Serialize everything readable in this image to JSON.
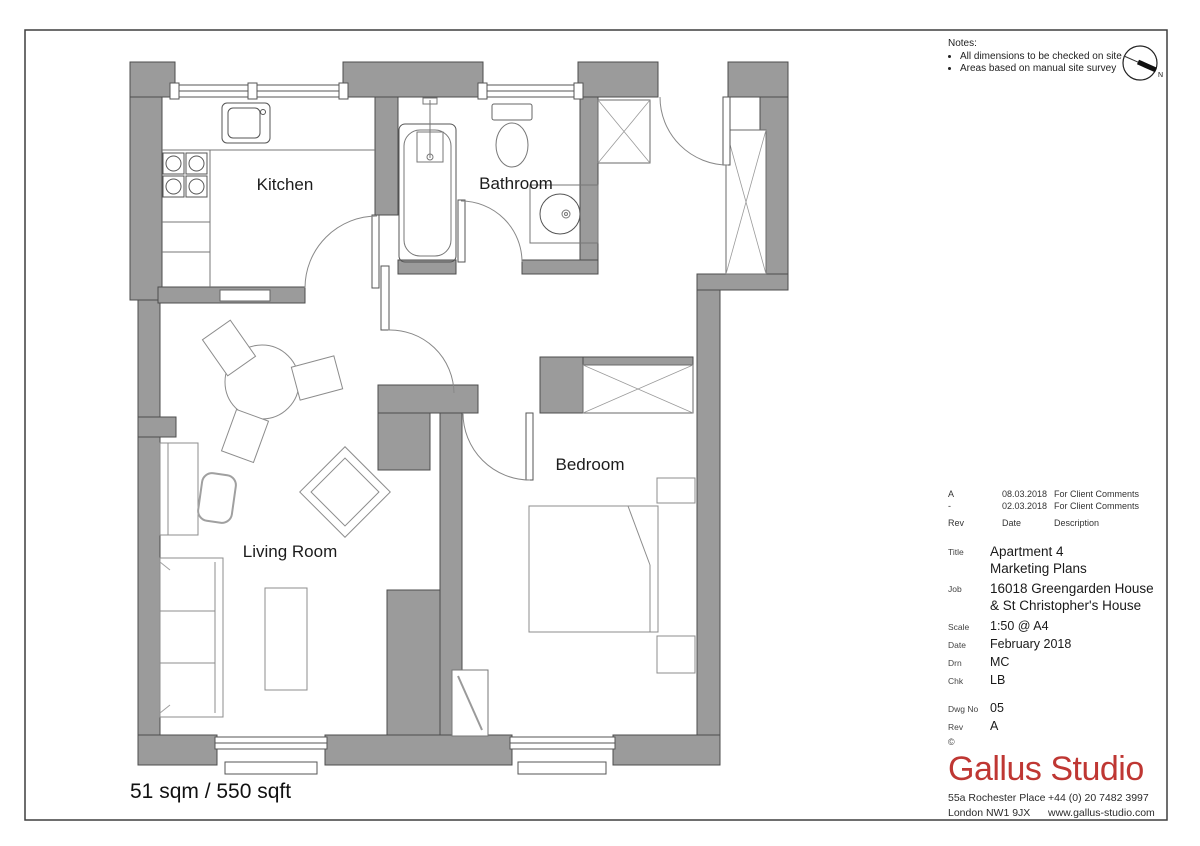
{
  "plan": {
    "rooms": {
      "kitchen": "Kitchen",
      "bathroom": "Bathroom",
      "bedroom": "Bedroom",
      "living": "Living Room"
    },
    "area_label": "51 sqm / 550 sqft",
    "north_label": "N"
  },
  "titleblock": {
    "notes_heading": "Notes:",
    "notes": [
      "All dimensions to be checked on site",
      "Areas based on manual site survey"
    ],
    "revisions": [
      {
        "rev": "A",
        "date": "08.03.2018",
        "desc": "For Client Comments"
      },
      {
        "rev": "-",
        "date": "02.03.2018",
        "desc": "For Client Comments"
      }
    ],
    "rev_headers": {
      "rev": "Rev",
      "date": "Date",
      "desc": "Description"
    },
    "title": {
      "label": "Title",
      "value": "Apartment 4\nMarketing Plans"
    },
    "job": {
      "label": "Job",
      "value": "16018 Greengarden House\n& St Christopher's House"
    },
    "scale": {
      "label": "Scale",
      "value": "1:50 @ A4"
    },
    "date": {
      "label": "Date",
      "value": "February 2018"
    },
    "drn": {
      "label": "Drn",
      "value": "MC"
    },
    "chk": {
      "label": "Chk",
      "value": "LB"
    },
    "dwg_no": {
      "label": "Dwg No",
      "value": "05"
    },
    "rev": {
      "label": "Rev",
      "value": "A"
    },
    "copyright": "©"
  },
  "brand": {
    "name": "Gallus Studio",
    "address_line1": "55a Rochester Place",
    "address_line2": "London NW1 9JX",
    "phone": "+44 (0) 20 7482 3997",
    "website": "www.gallus-studio.com"
  },
  "colors": {
    "wall_gray": "#9b9b9b",
    "wall_outline": "#4d4d4d",
    "logo_red": "#bf3733",
    "line_dark": "#555555",
    "line_light": "#8c8c8c"
  }
}
